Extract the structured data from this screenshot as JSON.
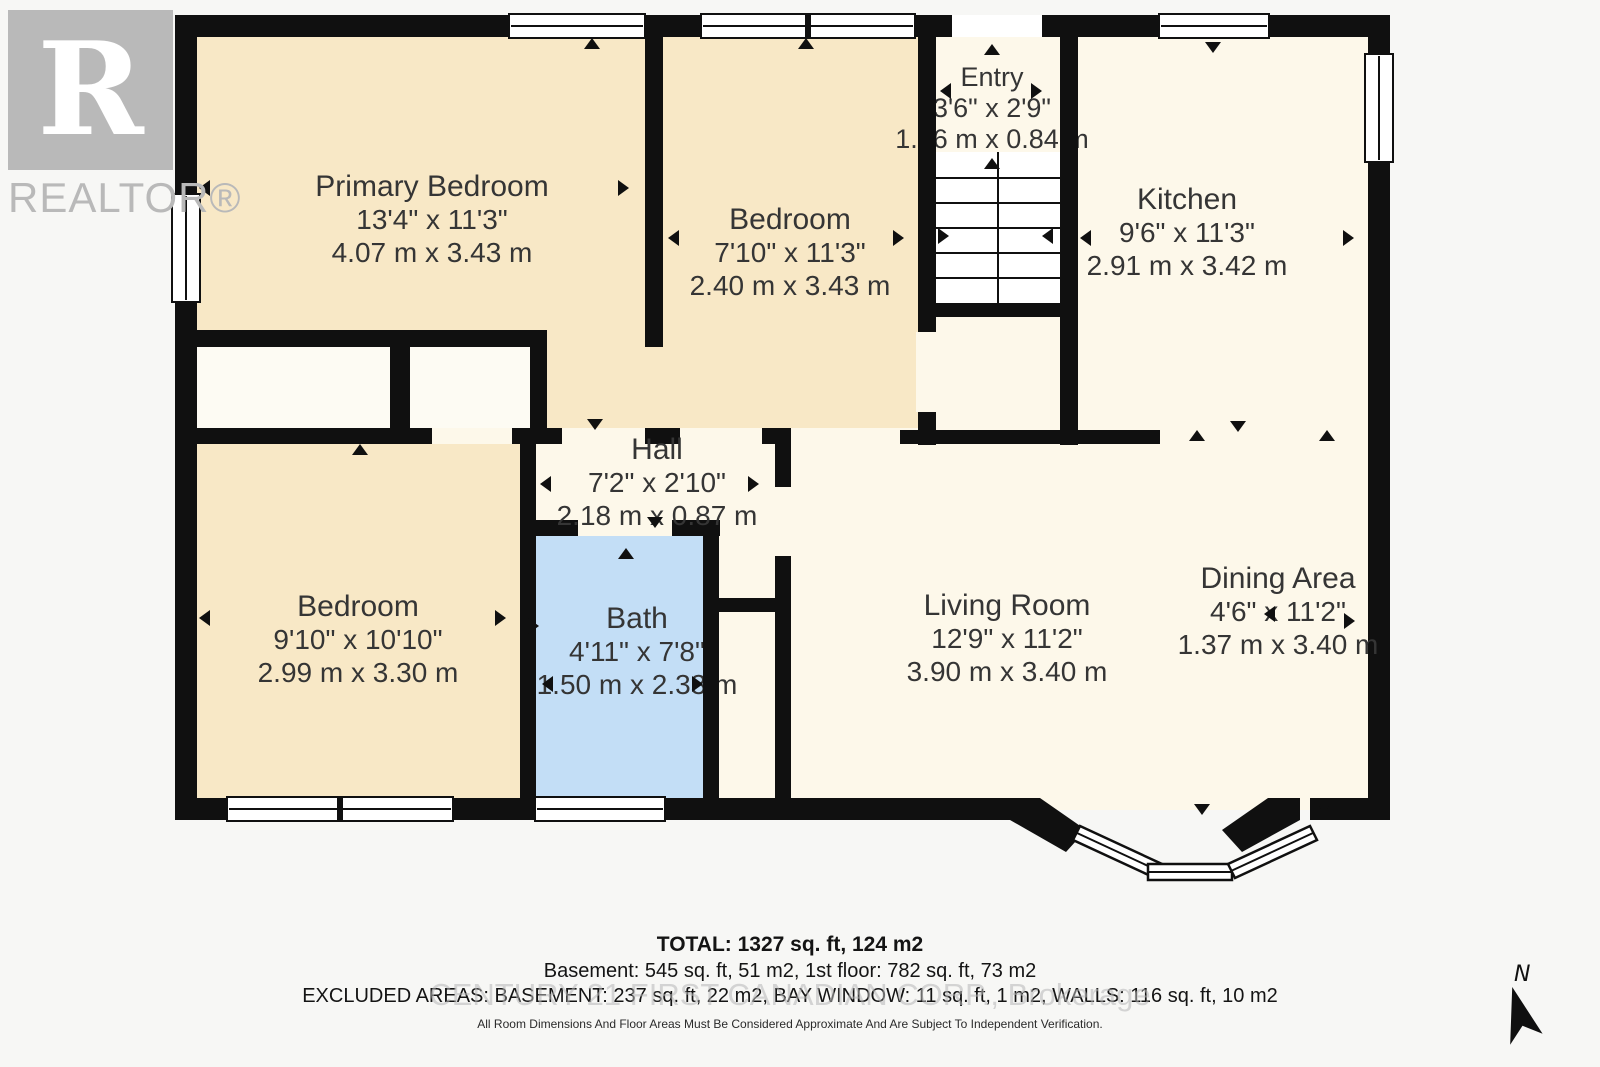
{
  "branding": {
    "logo_letter": "R",
    "logo_text": "REALTOR®"
  },
  "compass": {
    "label": "N"
  },
  "rooms": {
    "primary_bedroom": {
      "name": "Primary Bedroom",
      "imperial": "13'4\" x 11'3\"",
      "metric": "4.07 m x 3.43 m"
    },
    "bedroom_top": {
      "name": "Bedroom",
      "imperial": "7'10\" x 11'3\"",
      "metric": "2.40 m x 3.43 m"
    },
    "entry": {
      "name": "Entry",
      "imperial": "3'6\" x 2'9\"",
      "metric": "1.06 m x 0.84 m"
    },
    "kitchen": {
      "name": "Kitchen",
      "imperial": "9'6\" x 11'3\"",
      "metric": "2.91 m x 3.42 m"
    },
    "hall": {
      "name": "Hall",
      "imperial": "7'2\" x 2'10\"",
      "metric": "2.18 m x 0.87 m"
    },
    "bedroom_left": {
      "name": "Bedroom",
      "imperial": "9'10\" x 10'10\"",
      "metric": "2.99 m x 3.30 m"
    },
    "bath": {
      "name": "Bath",
      "imperial": "4'11\" x 7'8\"",
      "metric": "1.50 m x 2.33 m"
    },
    "living_room": {
      "name": "Living Room",
      "imperial": "12'9\" x 11'2\"",
      "metric": "3.90 m x 3.40 m"
    },
    "dining_area": {
      "name": "Dining Area",
      "imperial": "4'6\" x 11'2\"",
      "metric": "1.37 m x 3.40 m"
    }
  },
  "footer": {
    "total": "TOTAL: 1327 sq. ft, 124 m2",
    "floors": "Basement: 545 sq. ft, 51 m2, 1st floor: 782 sq. ft, 73 m2",
    "excluded": "EXCLUDED AREAS: BASEMENT: 237 sq. ft, 22 m2, BAY WINDOW: 11 sq. ft, 1 m2, WALLS: 116 sq. ft, 10 m2",
    "watermark": "CENTURY 21 FIRST CANADIAN CORP., Brokerage",
    "disclaimer": "All Room Dimensions And Floor Areas Must Be Considered Approximate And Are Subject To Independent Verification."
  },
  "icons": {
    "north_arrow": "navigation-arrow",
    "dimension_arrow": "solid-triangle",
    "realtor_mark": "block-R-on-gray"
  },
  "colors": {
    "wall": "#101010",
    "room_beige": "#f8e8c6",
    "room_cream": "#fdf8ea",
    "bath_blue": "#c3def6",
    "closet_white": "#fdfbf3",
    "logo_gray": "#b9b9b9",
    "page_bg": "#f7f7f5"
  }
}
